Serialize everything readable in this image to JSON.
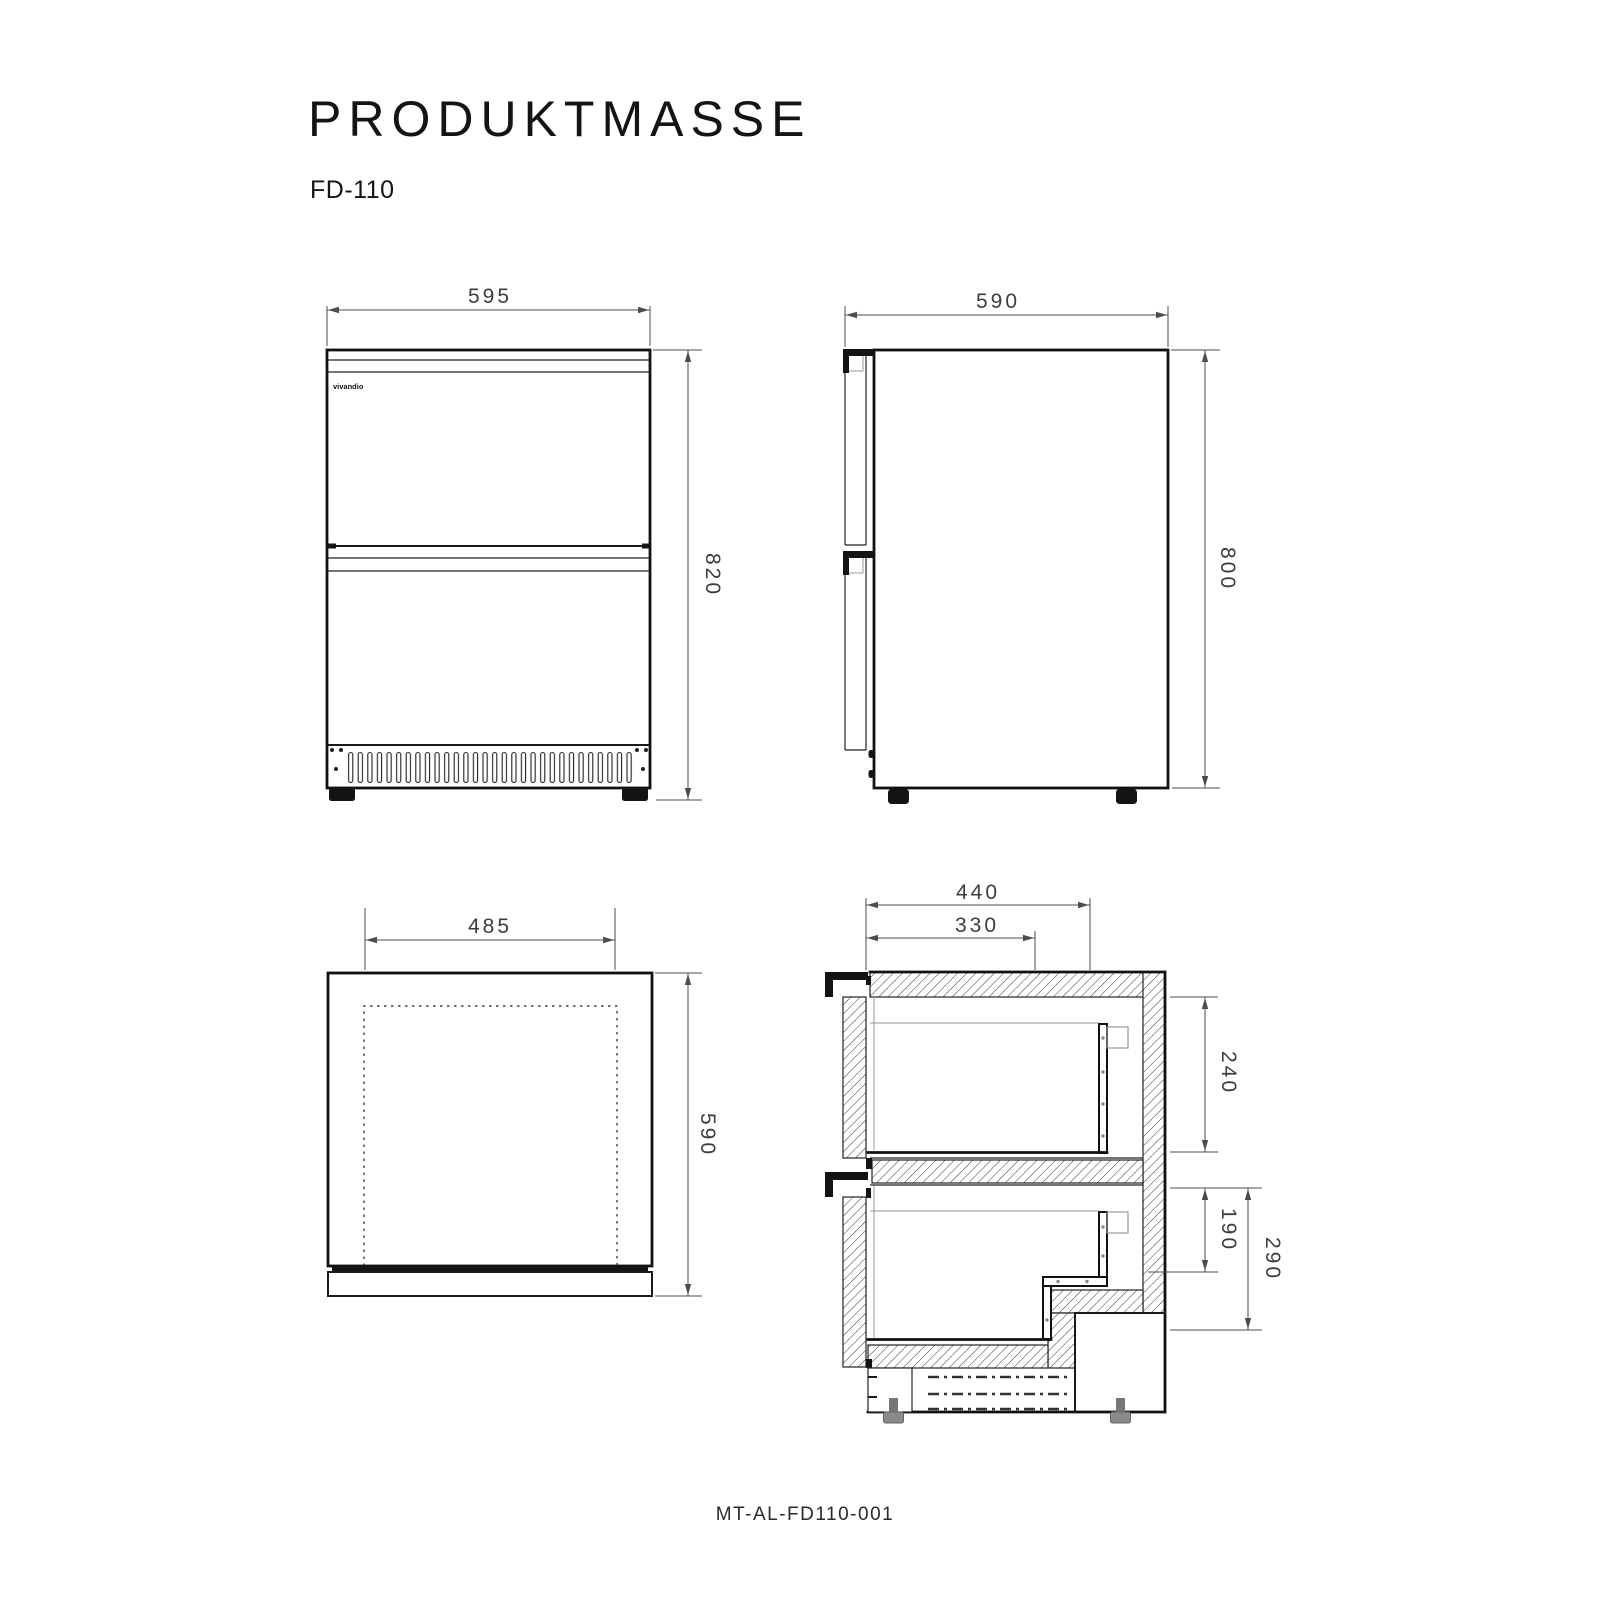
{
  "page": {
    "title": "PRODUKTMASSE",
    "model": "FD-110",
    "doc_number": "MT-AL-FD110-001",
    "brand_logo": "vivandio"
  },
  "views": {
    "front_view": {
      "width_mm": "595",
      "height_mm": "820"
    },
    "side_view": {
      "depth_mm": "590",
      "height_mm": "800"
    },
    "top_view": {
      "inner_width_mm": "485",
      "depth_mm": "590"
    },
    "section_view": {
      "depth_total_mm": "440",
      "depth_drawer_mm": "330",
      "upper_drawer_height_mm": "240",
      "lower_drawer_rear_height_mm": "190",
      "lower_drawer_height_mm": "290"
    }
  }
}
